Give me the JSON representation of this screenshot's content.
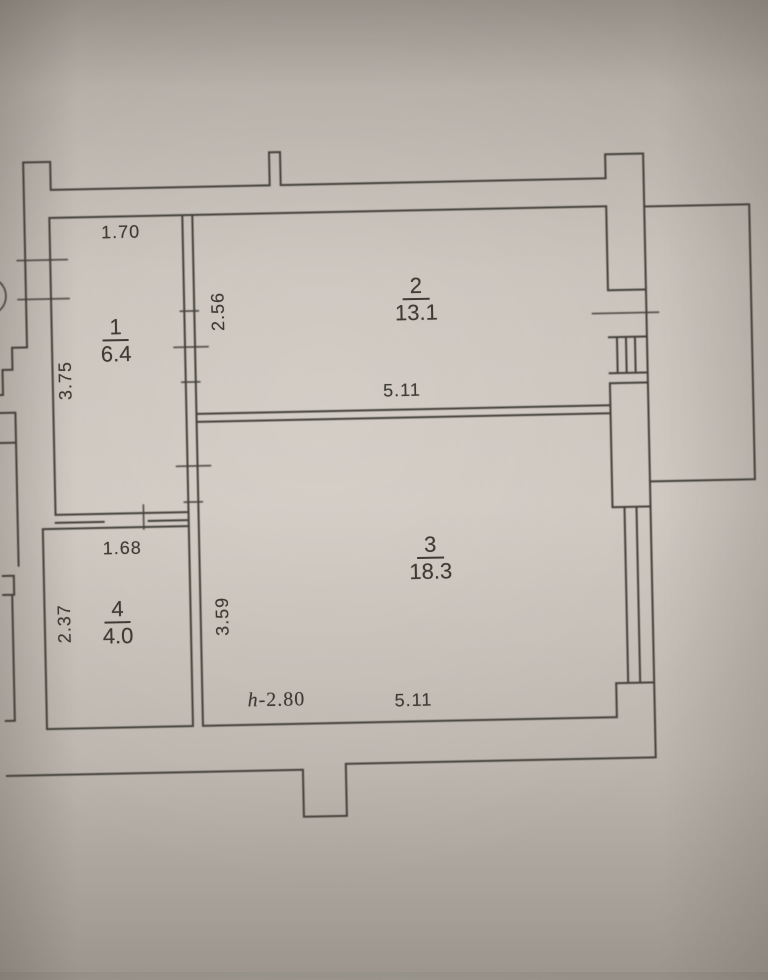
{
  "plan": {
    "rooms": [
      {
        "number": "1",
        "area": "6.4",
        "dim_top": "1.70",
        "dim_left": "3.75"
      },
      {
        "number": "2",
        "area": "13.1",
        "dim_left": "2.56",
        "dim_bottom": "5.11"
      },
      {
        "number": "3",
        "area": "18.3",
        "dim_left": "3.59",
        "dim_bottom": "5.11"
      },
      {
        "number": "4",
        "area": "4.0",
        "dim_top": "1.68",
        "dim_left": "2.37"
      }
    ],
    "ceiling_height_note": {
      "prefix": "h",
      "value": "-2.80"
    }
  },
  "colors": {
    "paper_center": "#cdc6be",
    "paper_edge": "#948e86",
    "line": "#43403a",
    "text": "#3e3a34"
  }
}
